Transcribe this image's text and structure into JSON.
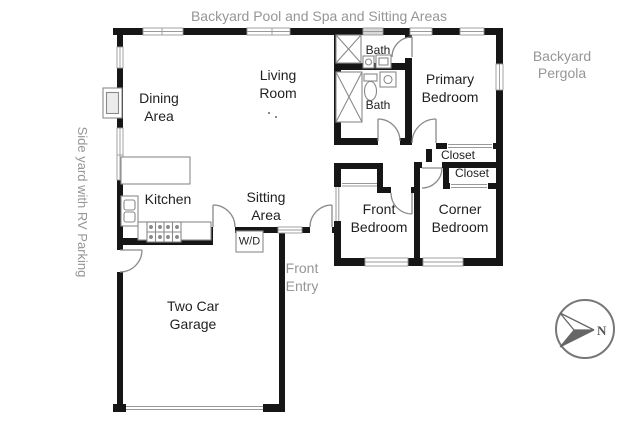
{
  "plan_title": "Backyard Pool and Spa and Sitting Areas",
  "exterior_labels": {
    "backyard_top": "Backyard Pool and Spa and Sitting Areas",
    "pergola": "Backyard\nPergola",
    "side_yard": "Side yard with RV Parking",
    "front_entry": "Front\nEntry"
  },
  "rooms": {
    "dining": "Dining\nArea",
    "living": "Living\nRoom",
    "kitchen": "Kitchen",
    "sitting": "Sitting\nArea",
    "garage": "Two Car\nGarage",
    "primary_bedroom": "Primary\nBedroom",
    "front_bedroom": "Front\nBedroom",
    "corner_bedroom": "Corner\nBedroom",
    "bath_upper": "Bath",
    "bath_lower": "Bath",
    "closet_primary": "Closet",
    "closet_corner": "Closet",
    "washer_dryer": "W/D"
  },
  "compass": {
    "north": "N"
  },
  "colors": {
    "wall": "#161616",
    "thin_line": "#8a8a8a",
    "window_line": "#999999",
    "room_text": "#1f1f1f",
    "exterior_text": "#969696",
    "compass": "#666666",
    "background": "#ffffff"
  }
}
